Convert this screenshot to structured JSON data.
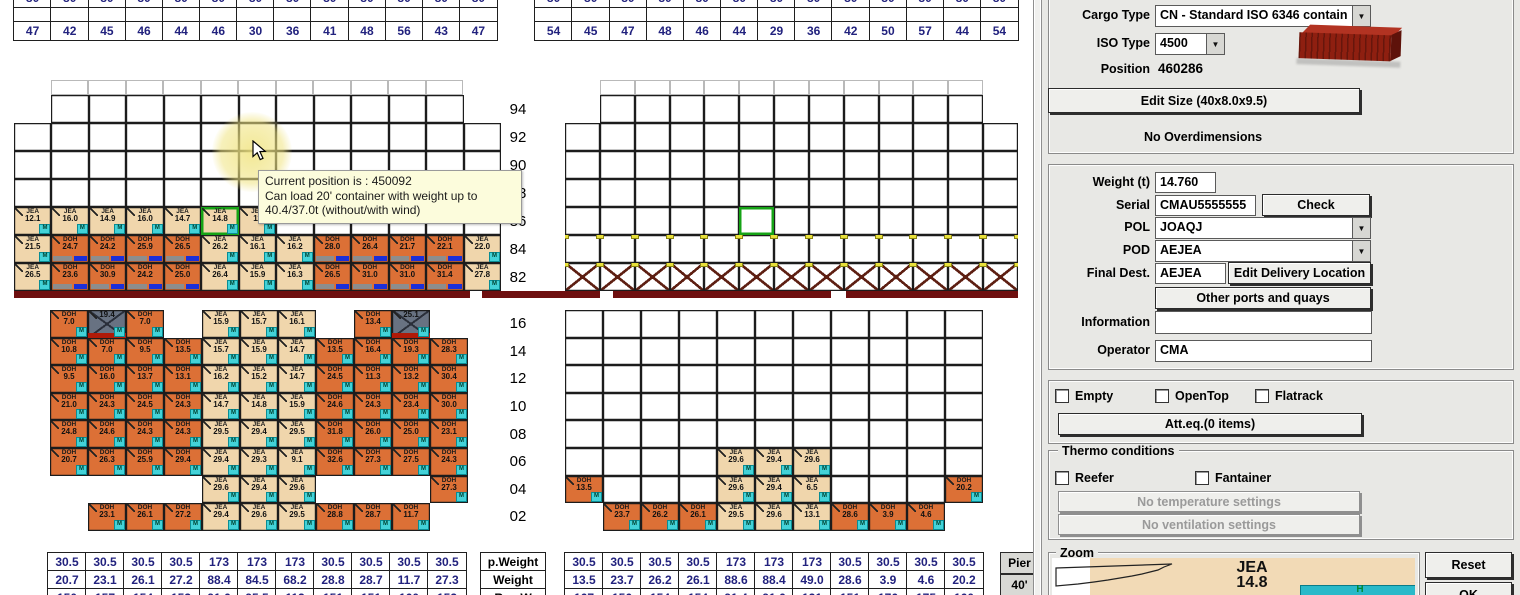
{
  "colors": {
    "tan": "#f0d6ac",
    "orange": "#dc7036",
    "selection_green": "#16a316",
    "hatch_red": "#6e0f0f",
    "badge_cyan": "#43d2d8",
    "table_navy": "#22227e",
    "tooltip_bg": "#fcfcdc"
  },
  "tooltip": {
    "lines": [
      "Current position is : 450092",
      "Can load 20' container with weight up to",
      "40.4/37.0t (without/with wind)"
    ]
  },
  "tables": {
    "top_left": [
      [
        "80",
        "80",
        "80",
        "80",
        "80",
        "80",
        "80",
        "80",
        "80",
        "80",
        "80",
        "80",
        "80"
      ],
      [
        "",
        "",
        "",
        "",
        "",
        "",
        "",
        "",
        "",
        "",
        "",
        "",
        ""
      ],
      [
        "47",
        "42",
        "45",
        "46",
        "44",
        "46",
        "30",
        "36",
        "41",
        "48",
        "56",
        "43",
        "47"
      ]
    ],
    "top_right": [
      [
        "80",
        "80",
        "80",
        "80",
        "80",
        "80",
        "80",
        "80",
        "80",
        "80",
        "80",
        "80",
        "80"
      ],
      [
        "",
        "",
        "",
        "",
        "",
        "",
        "",
        "",
        "",
        "",
        "",
        "",
        ""
      ],
      [
        "54",
        "45",
        "47",
        "48",
        "46",
        "44",
        "29",
        "36",
        "42",
        "50",
        "57",
        "44",
        "54"
      ]
    ],
    "bottom_labels": [
      [
        "p.Weight"
      ],
      [
        "Weight"
      ],
      [
        "RemW"
      ]
    ],
    "bottom_left": [
      [
        "30.5",
        "30.5",
        "30.5",
        "30.5",
        "173",
        "173",
        "173",
        "30.5",
        "30.5",
        "30.5",
        "30.5"
      ],
      [
        "20.7",
        "23.1",
        "26.1",
        "27.2",
        "88.4",
        "84.5",
        "68.2",
        "28.8",
        "28.7",
        "11.7",
        "27.3"
      ],
      [
        "150",
        "157",
        "154",
        "153",
        "91.6",
        "95.5",
        "112",
        "151",
        "151",
        "160",
        "152"
      ]
    ],
    "bottom_right": [
      [
        "30.5",
        "30.5",
        "30.5",
        "30.5",
        "173",
        "173",
        "173",
        "30.5",
        "30.5",
        "30.5",
        "30.5"
      ],
      [
        "13.5",
        "23.7",
        "26.2",
        "26.1",
        "88.6",
        "88.4",
        "49.0",
        "28.6",
        "3.9",
        "4.6",
        "20.2"
      ],
      [
        "167",
        "156",
        "154",
        "154",
        "91.4",
        "91.6",
        "121",
        "151",
        "176",
        "175",
        "160"
      ]
    ],
    "side_buttons": [
      "Pier",
      "40'"
    ]
  },
  "bays": {
    "tiers_upper": [
      "94",
      "92",
      "90",
      "88",
      "86",
      "84",
      "82"
    ],
    "tiers_lower": [
      "16",
      "14",
      "12",
      "10",
      "08",
      "06",
      "04",
      "02"
    ],
    "upper_left": [
      [
        "-",
        "E",
        "E",
        "E",
        "E",
        "E",
        "E",
        "E",
        "E",
        "E",
        "E",
        "E",
        "-"
      ],
      [
        "E",
        "E",
        "E",
        "E",
        "E",
        "E",
        "E",
        "E",
        "E",
        "E",
        "E",
        "E",
        "E"
      ],
      [
        "E",
        "E",
        "E",
        "E",
        "E",
        "E",
        "E",
        "E",
        "E",
        "E",
        "E",
        "E",
        "E"
      ],
      [
        "E",
        "E",
        "E",
        "E",
        "E",
        "E",
        "E",
        "E",
        "E",
        "E",
        "E",
        "E",
        "E"
      ],
      [
        "J:12.1",
        "J:16.0",
        "J:14.9",
        "J:16.0",
        "J:14.7",
        "!J:14.8",
        "J:11",
        "E",
        "E",
        "E",
        "E",
        "E",
        "E"
      ],
      [
        "J:21.5",
        "D:24.7",
        "D:24.2",
        "D:25.9",
        "D:26.5",
        "J:26.2",
        "J:16.1",
        "J:16.2",
        "D:28.0",
        "D:26.4",
        "D:21.7",
        "D:22.1",
        "J:22.0"
      ],
      [
        "J:26.5",
        "D:23.6",
        "D:30.9",
        "D:24.2",
        "D:25.0",
        "J:26.4",
        "J:15.9",
        "J:16.3",
        "D:26.5",
        "D:31.0",
        "D:31.0",
        "D:31.4",
        "J:27.8"
      ]
    ],
    "upper_right": [
      [
        "-",
        "E",
        "E",
        "E",
        "E",
        "E",
        "E",
        "E",
        "E",
        "E",
        "E",
        "E",
        "-"
      ],
      [
        "E",
        "E",
        "E",
        "E",
        "E",
        "E",
        "E",
        "E",
        "E",
        "E",
        "E",
        "E",
        "E"
      ],
      [
        "E",
        "E",
        "E",
        "E",
        "E",
        "E",
        "E",
        "E",
        "E",
        "E",
        "E",
        "E",
        "E"
      ],
      [
        "E",
        "E",
        "E",
        "E",
        "E",
        "E",
        "E",
        "E",
        "E",
        "E",
        "E",
        "E",
        "E"
      ],
      [
        "X",
        "X",
        "X",
        "X",
        "X",
        "!X",
        "X",
        "X",
        "X",
        "X",
        "X",
        "X",
        "X"
      ],
      [
        "XY",
        "XY",
        "XY",
        "XY",
        "XY",
        "XY",
        "XY",
        "XY",
        "XY",
        "XY",
        "XY",
        "XY",
        "XY"
      ],
      [
        "XR",
        "XR",
        "XR",
        "XR",
        "XR",
        "XR",
        "XR",
        "XR",
        "XR",
        "XR",
        "XR",
        "XR",
        "XR"
      ]
    ],
    "lower_left": [
      [
        "D:7.0",
        "G:19.4",
        "D:7.0",
        "-",
        "J:15.9",
        "J:15.7",
        "J:16.1",
        "-",
        "D:13.4",
        "G:25.1",
        "-"
      ],
      [
        "D:10.8",
        "D:7.0",
        "D:9.5",
        "D:13.5",
        "J:15.7",
        "J:15.9",
        "J:14.7",
        "D:13.5",
        "D:16.4",
        "D:19.3",
        "D:28.3"
      ],
      [
        "D:9.5",
        "D:16.0",
        "D:13.7",
        "D:13.1",
        "J:16.2",
        "J:15.2",
        "J:14.7",
        "D:24.5",
        "D:11.3",
        "D:13.2",
        "D:30.4"
      ],
      [
        "D:21.0",
        "D:24.3",
        "D:24.5",
        "D:24.3",
        "J:14.7",
        "J:14.8",
        "J:15.9",
        "D:24.6",
        "D:24.3",
        "D:23.4",
        "D:30.0"
      ],
      [
        "D:24.8",
        "D:24.6",
        "D:24.3",
        "D:24.3",
        "J:29.5",
        "J:29.4",
        "J:29.5",
        "D:31.8",
        "D:26.0",
        "D:25.0",
        "D:23.1"
      ],
      [
        "D:20.7",
        "D:26.3",
        "D:25.9",
        "D:29.4",
        "J:29.4",
        "J:29.3",
        "J:9.1",
        "D:32.6",
        "D:27.3",
        "D:27.5",
        "D:24.3"
      ],
      [
        "-",
        "-",
        "-",
        "-",
        "J:29.6",
        "J:29.4",
        "J:29.6",
        "-",
        "-",
        "-",
        "D:27.3"
      ],
      [
        "-",
        "D:23.1",
        "D:26.1",
        "D:27.2",
        "J:29.4",
        "J:29.6",
        "J:29.5",
        "D:28.8",
        "D:28.7",
        "D:11.7",
        "-"
      ]
    ],
    "lower_right": [
      [
        "E",
        "E",
        "E",
        "E",
        "E",
        "E",
        "E",
        "E",
        "E",
        "E",
        "E"
      ],
      [
        "X",
        "X",
        "X",
        "X",
        "X",
        "X",
        "X",
        "X",
        "X",
        "X",
        "X"
      ],
      [
        "X",
        "X",
        "X",
        "X",
        "X",
        "X",
        "X",
        "X",
        "X",
        "X",
        "X"
      ],
      [
        "X",
        "X",
        "X",
        "X",
        "X",
        "X",
        "X",
        "X",
        "X",
        "X",
        "X"
      ],
      [
        "X",
        "X",
        "X",
        "X",
        "X",
        "X",
        "X",
        "X",
        "X",
        "X",
        "X"
      ],
      [
        "X",
        "X",
        "X",
        "X",
        "J:29.6",
        "J:29.4",
        "J:29.6",
        "X",
        "X",
        "X",
        "X"
      ],
      [
        "D:13.5",
        "X",
        "X",
        "X",
        "J:29.6",
        "J:29.4",
        "J:6.5",
        "X",
        "X",
        "X",
        "D:20.2"
      ],
      [
        "-",
        "D:23.7",
        "D:26.2",
        "D:26.1",
        "J:29.5",
        "J:29.6",
        "J:13.1",
        "D:28.6",
        "D:3.9",
        "D:4.6",
        "-"
      ]
    ]
  },
  "panel": {
    "cargo_type": {
      "label": "Cargo Type",
      "value": "CN - Standard ISO 6346 contain"
    },
    "iso_type": {
      "label": "ISO Type",
      "value": "4500"
    },
    "position": {
      "label": "Position",
      "value": "460286"
    },
    "edit_size_button": "Edit Size (40x8.0x9.5)",
    "overdimensions": "No Overdimensions",
    "weight": {
      "label": "Weight (t)",
      "value": "14.760"
    },
    "serial": {
      "label": "Serial",
      "value": "CMAU5555555",
      "check_button": "Check"
    },
    "pol": {
      "label": "POL",
      "value": "JOAQJ"
    },
    "pod": {
      "label": "POD",
      "value": "AEJEA"
    },
    "final_dest": {
      "label": "Final Dest.",
      "value": "AEJEA",
      "edit_button": "Edit Delivery Location"
    },
    "other_ports_button": "Other ports and quays",
    "information": {
      "label": "Information",
      "value": ""
    },
    "operator": {
      "label": "Operator",
      "value": "CMA"
    },
    "flags": {
      "empty": "Empty",
      "opentop": "OpenTop",
      "flatrack": "Flatrack"
    },
    "atteq_button": "Att.eq.(0 items)",
    "thermo": {
      "title": "Thermo conditions",
      "reefer": "Reefer",
      "fantainer": "Fantainer",
      "temp_button": "No temperature settings",
      "vent_button": "No ventilation settings"
    },
    "zoom": {
      "title": "Zoom",
      "preview_type": "JEA",
      "preview_weight": "14.8",
      "reset_button": "Reset",
      "ok_button": "OK"
    }
  }
}
